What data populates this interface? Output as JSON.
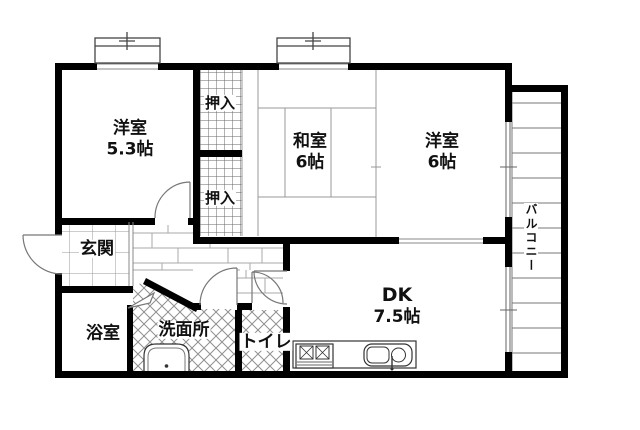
{
  "floor_plan": {
    "type": "japanese-apartment-floor-plan",
    "rooms": {
      "western1": {
        "name": "洋室",
        "size": "5.3帖"
      },
      "closet_upper": {
        "name": "押入"
      },
      "closet_lower": {
        "name": "押入"
      },
      "japanese": {
        "name": "和室",
        "size": "6帖"
      },
      "western2": {
        "name": "洋室",
        "size": "6帖"
      },
      "dining_kitchen": {
        "name": "DK",
        "size": "7.5帖"
      },
      "entrance": {
        "name": "玄関"
      },
      "bathroom": {
        "name": "浴室"
      },
      "washroom": {
        "name": "洗面所"
      },
      "toilet": {
        "name": "トイレ"
      },
      "balcony": {
        "name": "バルコニー"
      }
    },
    "fixtures": {
      "kitchen_sink": "sink-icon",
      "gas_stove": "stove-icon",
      "washbasin": "washbasin-icon"
    },
    "colors": {
      "wall": "#000000",
      "thin_line": "#888888",
      "fixture_line": "#333333",
      "background": "#ffffff"
    }
  }
}
